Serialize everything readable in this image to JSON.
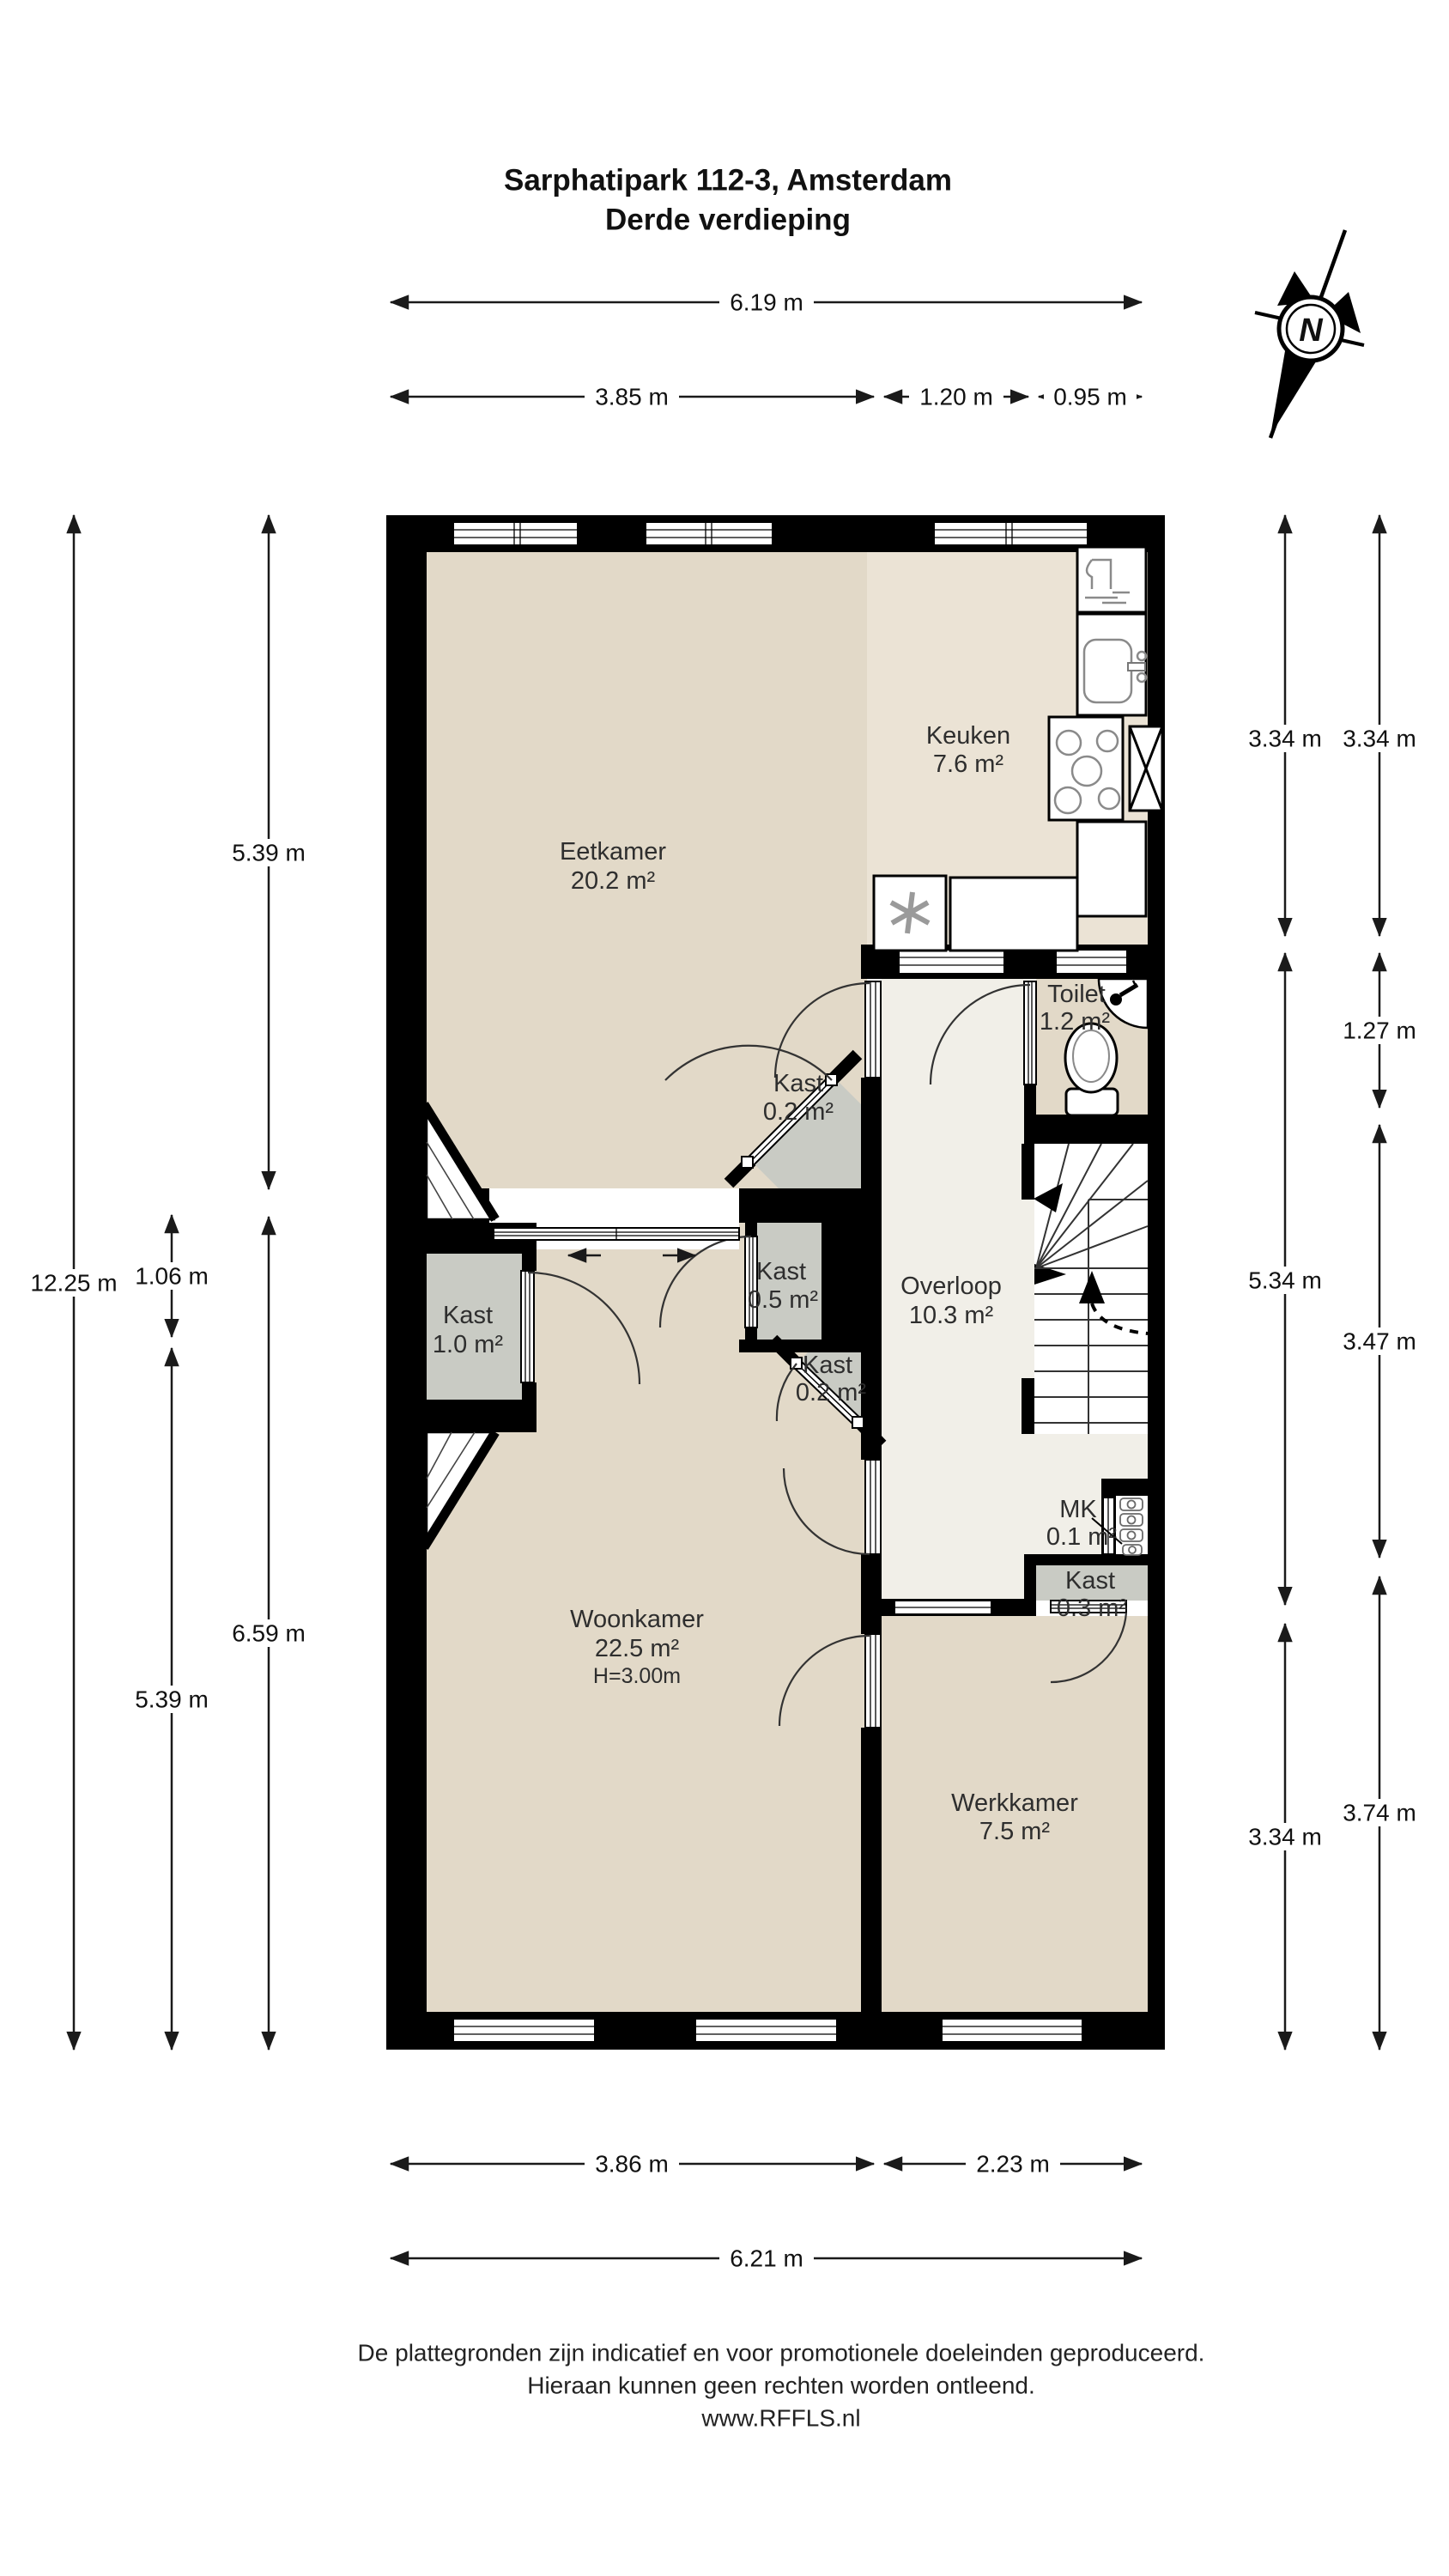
{
  "title": {
    "line1": "Sarphatipark 112-3, Amsterdam",
    "line2": "Derde verdieping"
  },
  "compass": {
    "label": "N"
  },
  "rooms": {
    "eetkamer": {
      "name": "Eetkamer",
      "area": "20.2 m²"
    },
    "keuken": {
      "name": "Keuken",
      "area": "7.6 m²"
    },
    "toilet": {
      "name": "Toilet",
      "area": "1.2 m²"
    },
    "overloop": {
      "name": "Overloop",
      "area": "10.3 m²"
    },
    "woonkamer": {
      "name": "Woonkamer",
      "area": "22.5 m²",
      "height": "H=3.00m"
    },
    "werkkamer": {
      "name": "Werkkamer",
      "area": "7.5 m²"
    },
    "kast_links": {
      "name": "Kast",
      "area": "1.0 m²"
    },
    "kast_midden": {
      "name": "Kast",
      "area": "0.5 m²"
    },
    "kast_boven": {
      "name": "Kast",
      "area": "0.2 m²"
    },
    "kast_onder": {
      "name": "Kast",
      "area": "0.2 m²"
    },
    "kast_klein": {
      "name": "Kast",
      "area": "0.3 m²"
    },
    "meterkast": {
      "name": "MK",
      "area": "0.1 m²"
    }
  },
  "dims": {
    "top_total": "6.19 m",
    "top_left": "3.85 m",
    "top_mid": "1.20 m",
    "top_right": "0.95 m",
    "left_total": "12.25 m",
    "left_top": "5.39 m",
    "left_kast": "1.06 m",
    "left_woonkamer": "5.39 m",
    "left_bottom": "6.59 m",
    "right_keuken_inner": "3.34 m",
    "right_keuken_outer": "3.34 m",
    "right_toilet": "1.27 m",
    "right_overloop_inner": "5.34 m",
    "right_overloop_outer": "3.47 m",
    "right_werkkamer_inner": "3.34 m",
    "right_werkkamer_outer": "3.74 m",
    "bottom_left": "3.86 m",
    "bottom_right": "2.23 m",
    "bottom_total": "6.21 m"
  },
  "footer": {
    "line1": "De plattegronden zijn indicatief en voor promotionele doeleinden geproduceerd.",
    "line2": "Hieraan kunnen geen rechten worden ontleend.",
    "line3": "www.RFFLS.nl"
  },
  "colors": {
    "wall": "#000000",
    "room_floor": "#e2d9c8",
    "kitchen_floor": "#ebe3d5",
    "hall_floor": "#f1efe8",
    "closet_fill": "#c9cbc4"
  }
}
